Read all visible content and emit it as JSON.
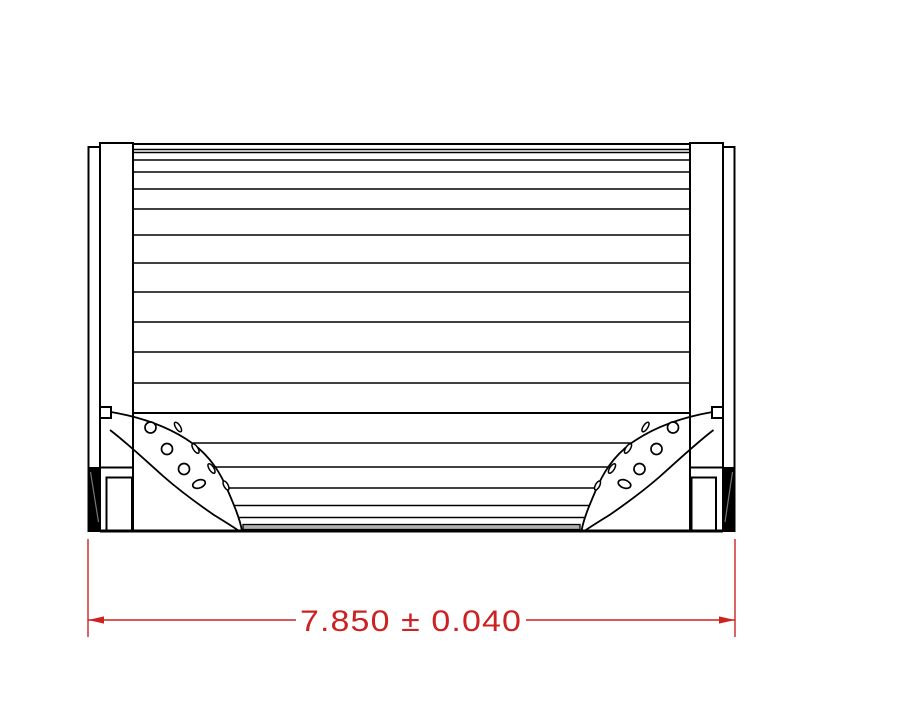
{
  "dimension": {
    "text": "7.850 ± 0.040",
    "value": "7.850",
    "plus_minus_symbol": "±",
    "tolerance": "0.040",
    "color": "#cc2222"
  },
  "drawing": {
    "stroke_color": "#000000",
    "background_color": "#ffffff",
    "gasket_fill_color": "#000000",
    "bottom_band_fill_color": "#b0b0b0",
    "description_labels": {
      "part": "filter-element-side-view"
    }
  }
}
